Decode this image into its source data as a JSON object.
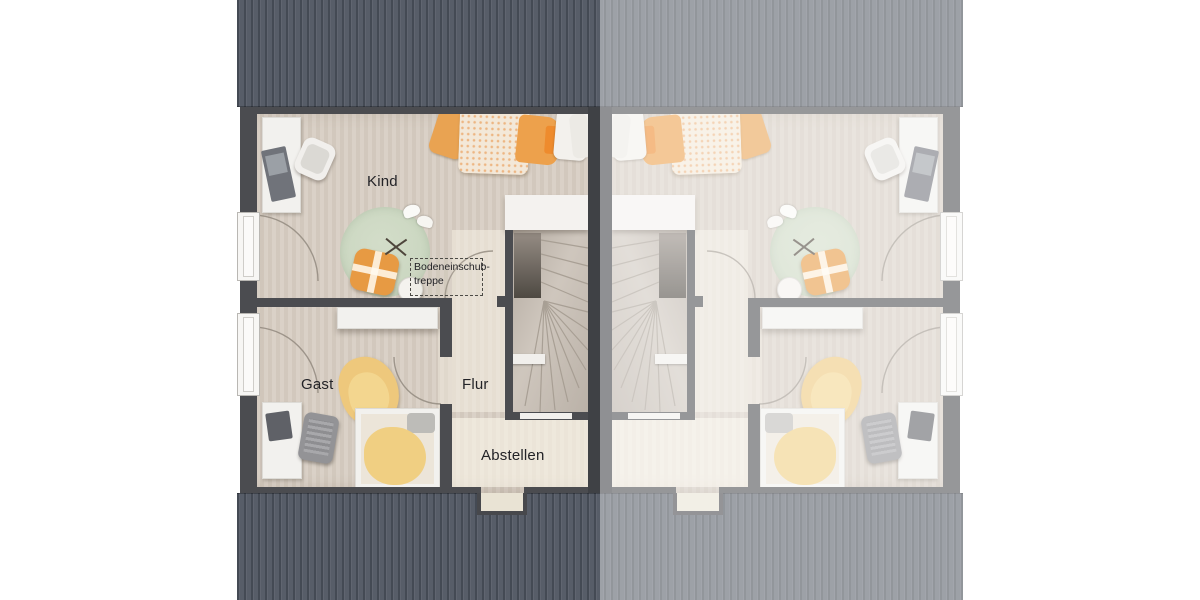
{
  "page": {
    "background": "#ffffff",
    "description": "Top-down 3D rendering of the attic floor plan of a semi-detached duplex house; left unit labeled, right unit mirrored and faded"
  },
  "floor_plan": {
    "rooms": [
      {
        "id": "kind",
        "label": "Kind"
      },
      {
        "id": "gast",
        "label": "Gast"
      },
      {
        "id": "flur",
        "label": "Flur"
      },
      {
        "id": "abstellen",
        "label": "Abstellen"
      }
    ],
    "annotation": {
      "line1": "Bodeneinschub-",
      "line2": "treppe"
    },
    "features": [
      "gable roof bands top and bottom",
      "two floor-to-ceiling windows with door-swing arcs on each gable wall",
      "central mirrored winder staircases along party wall",
      "attic pull-down ladder hatch marked with dashed rectangle",
      "chimney notch in lower roof edge of each unit"
    ],
    "colors": {
      "roof": "#575d68",
      "roof_faded": "#a3a8ae",
      "exterior_wall": "#4b4c50",
      "party_wall": "#3f4145",
      "floor": "#d8cfc4",
      "floor_light": "#ece5d6",
      "rug_green": "#ccd8c2",
      "bedding_orange": "#eda14c",
      "blanket_yellow": "#f0cf82",
      "furniture_white": "#f2f1ee",
      "label_text": "#232327"
    }
  }
}
